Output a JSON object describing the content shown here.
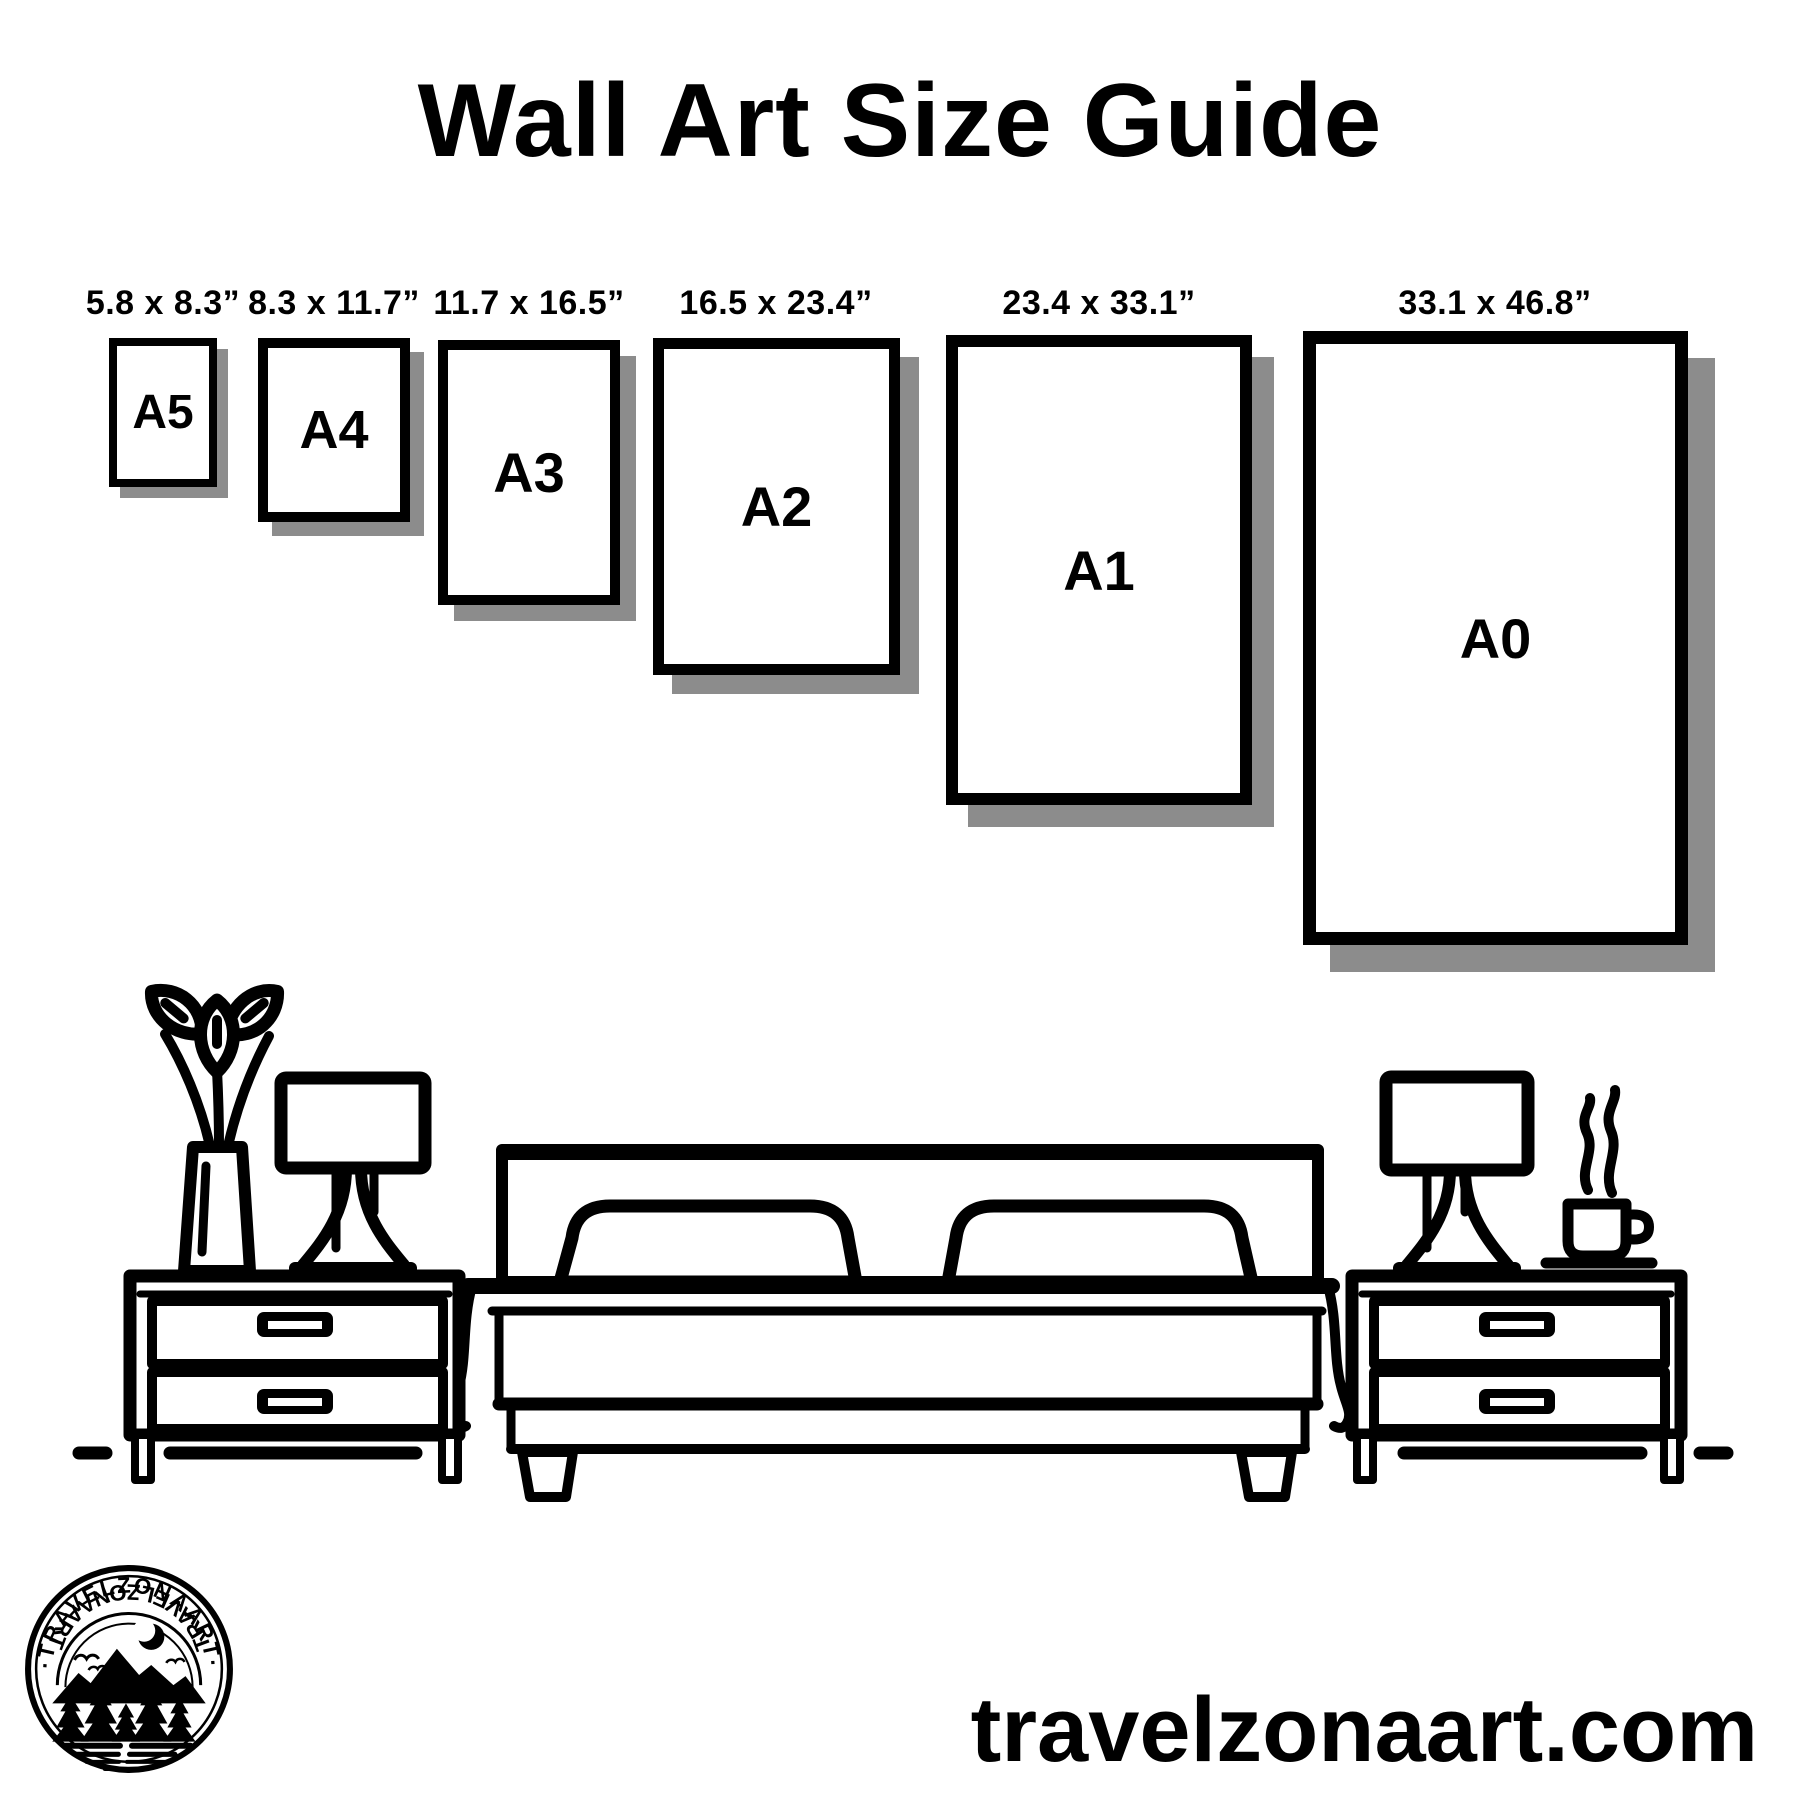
{
  "header": {
    "title": "Wall Art Size Guide"
  },
  "frames": [
    {
      "id": "a5",
      "label": "A5",
      "dimensions": "5.8 x 8.3”"
    },
    {
      "id": "a4",
      "label": "A4",
      "dimensions": "8.3 x 11.7”"
    },
    {
      "id": "a3",
      "label": "A3",
      "dimensions": "11.7 x 16.5”"
    },
    {
      "id": "a2",
      "label": "A2",
      "dimensions": "16.5 x 23.4”"
    },
    {
      "id": "a1",
      "label": "A1",
      "dimensions": "23.4 x 33.1”"
    },
    {
      "id": "a0",
      "label": "A0",
      "dimensions": "33.1 x 46.8”"
    }
  ],
  "logo": {
    "arc_top": "·TRAVELZONAART·",
    "arc_bottom": "TRAVELZONAART"
  },
  "footer": {
    "website": "travelzonaart.com"
  },
  "colors": {
    "ink": "#000000",
    "frame_shadow": "#8c8c8c",
    "background": "#ffffff"
  }
}
